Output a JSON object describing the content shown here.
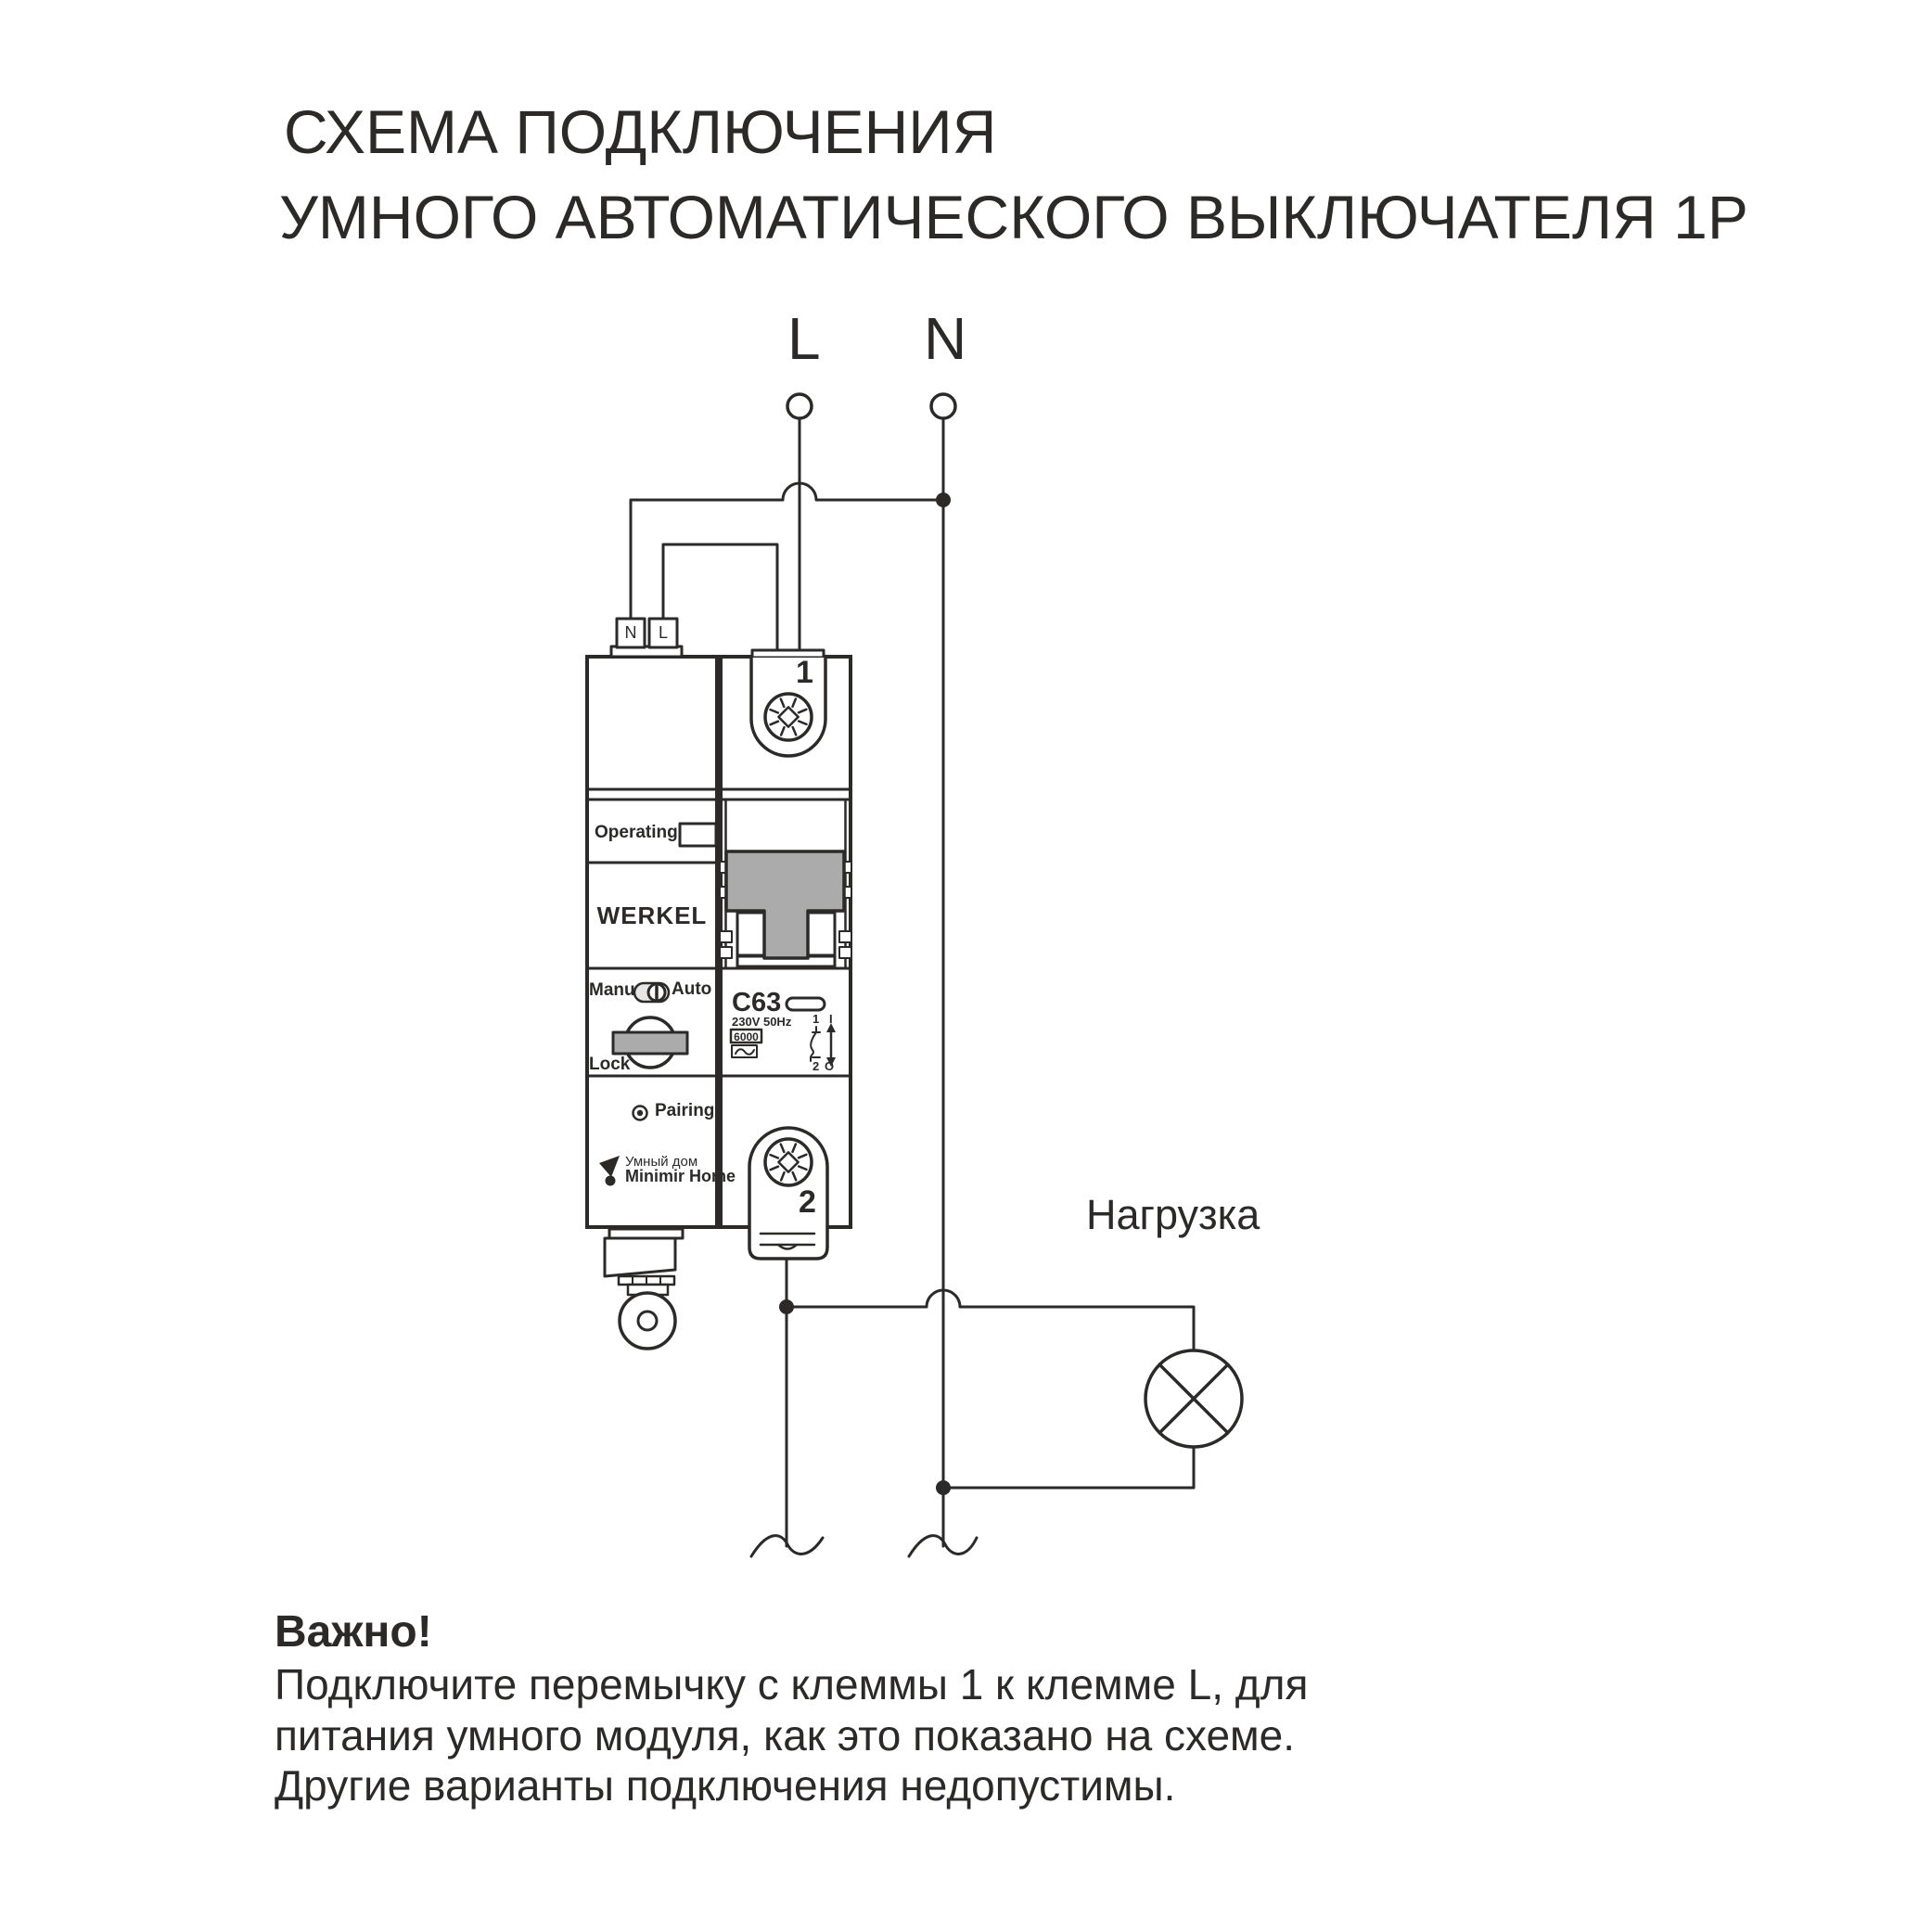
{
  "colors": {
    "line": "#2b2a29",
    "gray": "#ababab",
    "light": "#e6e6e6"
  },
  "title": {
    "line1": "СХЕМА ПОДКЛЮЧЕНИЯ",
    "line2": "УМНОГО АВТОМАТИЧЕСКОГО ВЫКЛЮЧАТЕЛЯ 1P"
  },
  "supply": {
    "line_label": "L",
    "neutral_label": "N"
  },
  "module": {
    "terminal_n": "N",
    "terminal_l": "L",
    "operating_label": "Operating",
    "brand": "WERKEL",
    "manu_label": "Manu",
    "auto_label": "Auto",
    "lock_label": "Lock",
    "pairing_label": "Pairing",
    "ecosystem_line1": "Умный дом",
    "ecosystem_line2": "Minimir Home"
  },
  "breaker": {
    "terminal1_label": "1",
    "terminal2_label": "2",
    "rating": "C63",
    "voltage": "230V 50Hz",
    "breaking_capacity": "6000",
    "contact_top": "1",
    "contact_bottom": "2",
    "on_label": "I",
    "off_label": "O"
  },
  "load_label": "Нагрузка",
  "note": {
    "heading": "Важно!",
    "line1": "Подключите перемычку с клеммы 1 к клемме L, для",
    "line2": "питания умного модуля, как это показано на схеме.",
    "line3": "Другие варианты подключения недопустимы."
  }
}
